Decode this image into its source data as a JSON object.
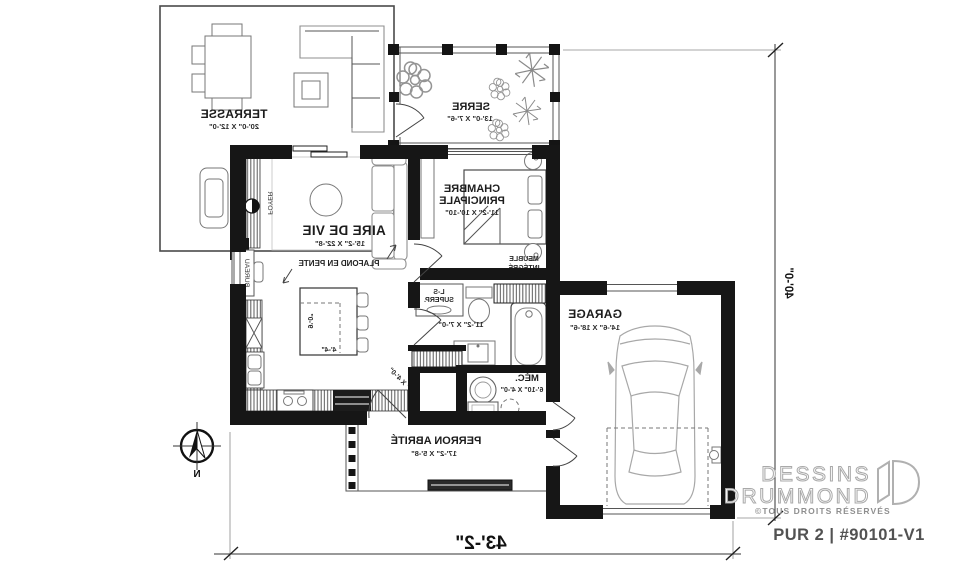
{
  "plan": {
    "terrasse": {
      "name": "TERRASSE",
      "dims": "20'-0\" X 12'-0\""
    },
    "serre": {
      "name": "SERRE",
      "dims": "13'-0\" X 7'-6\""
    },
    "chambre": {
      "name": "CHAMBRE",
      "name2": "PRINCIPALE",
      "dims": "11'-2\" X 10'-10\""
    },
    "aire": {
      "name": "AIRE DE VIE",
      "dims": "15'-2\" X 22'-8\"",
      "plafond": "PLAFOND EN PENTE",
      "foyer": "FOYER",
      "bureau": "BUREAU"
    },
    "kitchen": {
      "island_depth": "9'-0\"",
      "island_width": "4'-4\""
    },
    "bath": {
      "dims": "11'-2\" X 7'-0\"",
      "laundry1": "L-S",
      "laundry2": "SUPERP.",
      "builtin1": "MEUBLE",
      "builtin2": "INTÉGRÉ"
    },
    "mech": {
      "name": "MÉC.",
      "dims": "6'-10\" X 4'-0\""
    },
    "vestibule": {
      "dims": "4'-0\" X 4'-0\""
    },
    "garage": {
      "name": "GARAGE",
      "dims": "14'-6\" X 18'-6\""
    },
    "porch": {
      "name": "PERRON ABRITÉ",
      "dims": "17'-2\" X 5'-8\""
    },
    "north_letter": "N",
    "dim_width": "43'-2\"",
    "dim_height": "40'-0\""
  },
  "branding": {
    "brand1": "DESSINS",
    "brand2": "DRUMMOND",
    "rights": "©TOUS DROITS RÉSERVÉS",
    "model": "PUR 2 | #90101-V1"
  }
}
